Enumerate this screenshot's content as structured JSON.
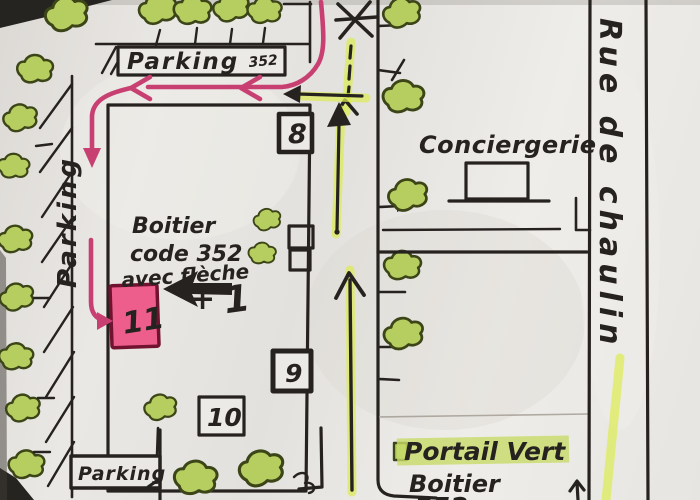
{
  "colors": {
    "paper": "#e8e6e2",
    "ink": "#26221f",
    "route_pink": "#c84071",
    "highlight_yellow": "#dcec55",
    "tree_fill": "#b6cd60",
    "tree_stroke": "#3c4517",
    "box11_fill": "#ee5e8d",
    "box11_border": "#701230",
    "pencil": "#a39d94"
  },
  "signs": {
    "top": "Parking",
    "top_code": "352",
    "left": "Parking",
    "bottom": "Parking"
  },
  "buildings": {
    "n8": "8",
    "n9": "9",
    "n10": "10",
    "n11": "11"
  },
  "places": {
    "conciergerie": "Conciergerie",
    "street": "Rue de chaulin",
    "portail": "Portail Vert"
  },
  "notes": {
    "boitier1": "Boitier",
    "boitier2": "code 352",
    "boitier3": "avec flèche",
    "plus": "+",
    "one": "1",
    "bottom_boitier": "Boitier",
    "bottom_code": "352"
  }
}
